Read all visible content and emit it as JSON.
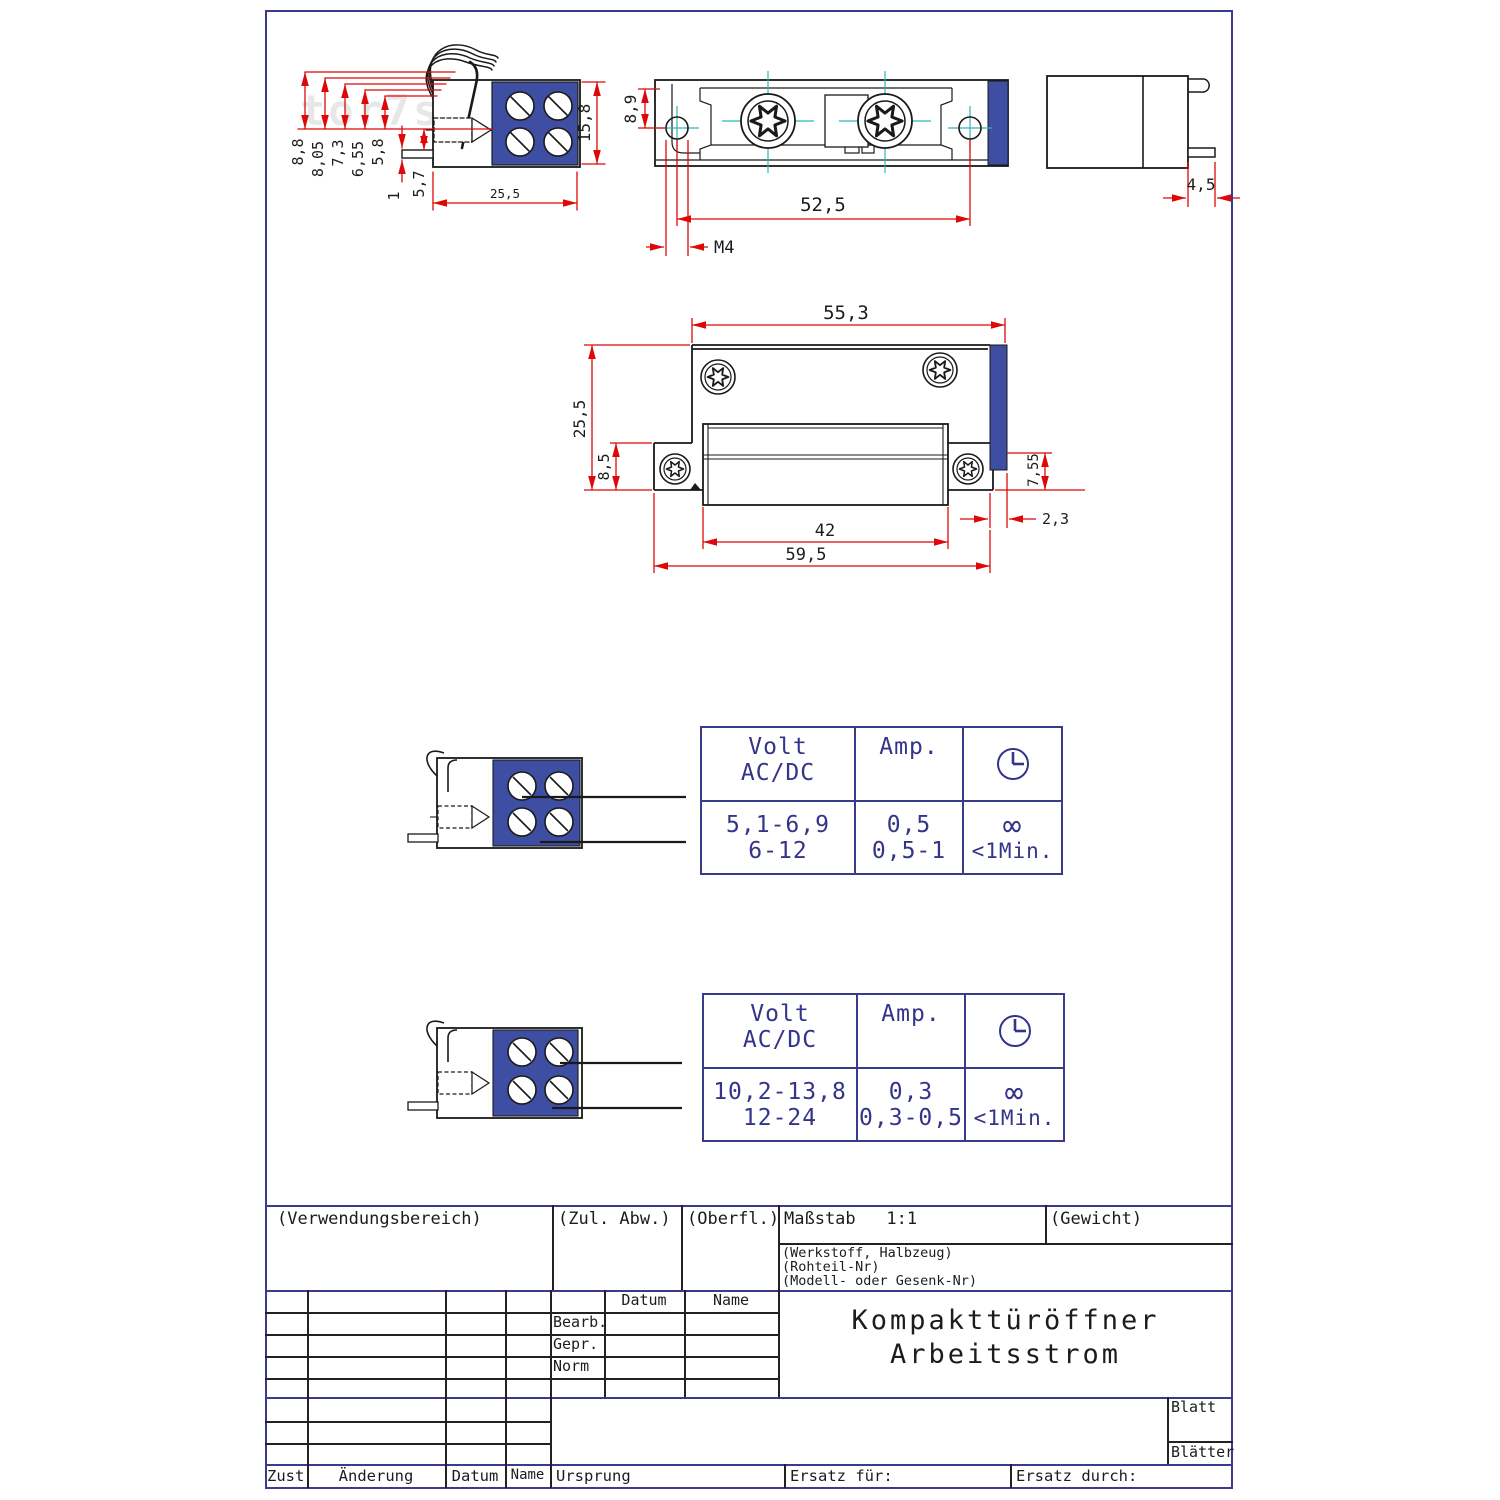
{
  "watermark": "tor7s",
  "views": {
    "side_view": {
      "dims": {
        "h1": "8,8",
        "h2": "8,05",
        "h3": "7,3",
        "h4": "6,55",
        "h5": "5,8",
        "pin": "1",
        "d57": "5,7",
        "width": "25,5",
        "height": "15,8"
      }
    },
    "front_view": {
      "dims": {
        "d89": "8,9",
        "d525": "52,5",
        "m4": "M4"
      }
    },
    "profile_view": {
      "dims": {
        "d45": "4,5"
      }
    },
    "main_view": {
      "dims": {
        "d553": "55,3",
        "d255": "25,5",
        "d85": "8,5",
        "d755": "7,55",
        "d23": "2,3",
        "d42": "42",
        "d595": "59,5"
      }
    }
  },
  "tables": [
    {
      "header": {
        "volt_line1": "Volt",
        "volt_line2": "AC/DC",
        "amp": "Amp."
      },
      "rows": [
        {
          "volt": "5,1-6,9",
          "amp": "0,5",
          "time": "∞"
        },
        {
          "volt": "6-12",
          "amp": "0,5-1",
          "time": "<1Min."
        }
      ]
    },
    {
      "header": {
        "volt_line1": "Volt",
        "volt_line2": "AC/DC",
        "amp": "Amp."
      },
      "rows": [
        {
          "volt": "10,2-13,8",
          "amp": "0,3",
          "time": "∞"
        },
        {
          "volt": "12-24",
          "amp": "0,3-0,5",
          "time": "<1Min."
        }
      ]
    }
  ],
  "title_block": {
    "verwendungsbereich": "(Verwendungsbereich)",
    "zul_abw": "(Zul. Abw.)",
    "oberfl": "(Oberfl.)",
    "massstab": "Maßstab   1:1",
    "gewicht": "(Gewicht)",
    "werkstoff": "(Werkstoff, Halbzeug)",
    "rohteil": "(Rohteil-Nr)",
    "modell": "(Modell- oder Gesenk-Nr)",
    "datum": "Datum",
    "name": "Name",
    "bearb": "Bearb.",
    "gepr": "Gepr.",
    "norm": "Norm",
    "title_line1": "Kompakttüröffner",
    "title_line2": "Arbeitsstrom",
    "blatt": "Blatt",
    "blaetter": "Blätter",
    "zust": "Zust",
    "aenderung": "Änderung",
    "datum2": "Datum",
    "name2": "Name",
    "ursprung": "Ursprung",
    "ersatz_fuer": "Ersatz für:",
    "ersatz_durch": "Ersatz durch:"
  },
  "colors": {
    "frame": "#3b3b8c",
    "dimension": "#dd0808",
    "centerline": "#2fb8b8",
    "terminal_blue": "#3e4fa3",
    "line": "#1a1a1a"
  }
}
